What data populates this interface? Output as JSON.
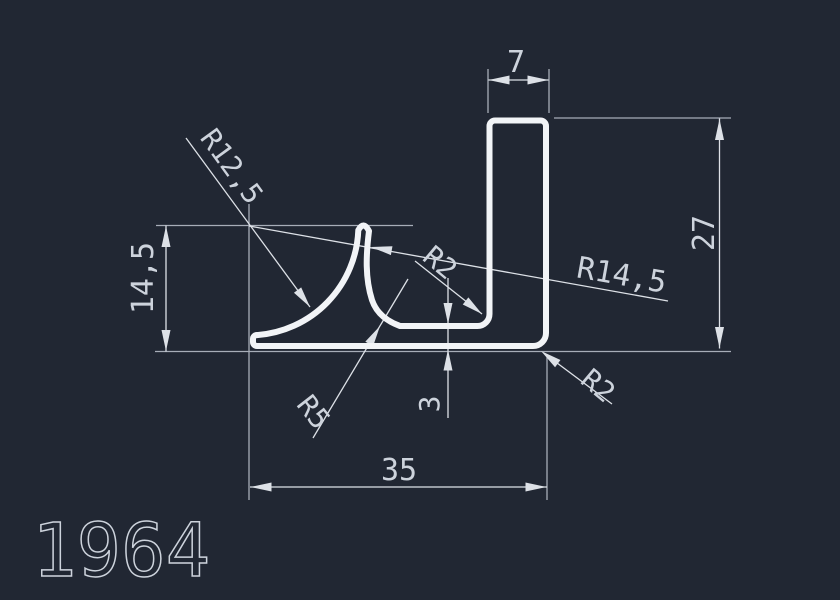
{
  "drawing": {
    "part_number": "1964",
    "labels": {
      "top_width": "7",
      "right_height": "27",
      "left_height": "14,5",
      "bottom_width": "35",
      "base_thickness": "3",
      "radius_fin_left": "R12,5",
      "radius_fin_right": "R14,5",
      "radius_floor_fillet": "R5",
      "radius_inner_fillet": "R2",
      "radius_outer_corner": "R2"
    },
    "colors": {
      "background": "#212733",
      "profile": "#f2f4f7",
      "dimension": "#dde1e7",
      "extension": "#a7adb8",
      "text": "#cdd3dc"
    }
  }
}
